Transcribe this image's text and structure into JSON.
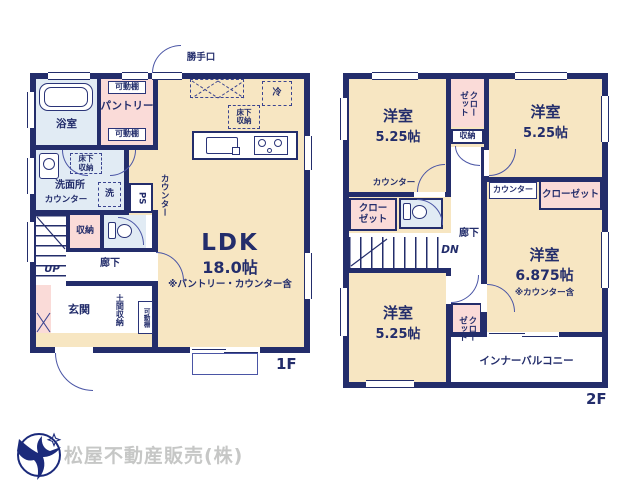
{
  "company": {
    "name": "松屋不動産販売(株)",
    "logo": "bird-in-circle"
  },
  "colors": {
    "wall_navy": "#232d6b",
    "room_beige": "#f7e6c2",
    "room_pink": "#fadbd8",
    "room_blue": "#e1ebf4",
    "line_navy": "#4a55a5",
    "logo_navy": "#1b2a7b",
    "company_gray": "#c6c7c6"
  },
  "f1": {
    "label": "1F",
    "ldk": {
      "name": "LDK",
      "size": "18.0帖",
      "note": "※パントリー・カウンター含"
    },
    "bathroom": "浴室",
    "pantry": "パントリー",
    "shelf_top": "可動棚",
    "shelf_bottom": "可動棚",
    "backdoor": "勝手口",
    "fridge": "冷",
    "underfloor_kitchen": "床下\n収納",
    "underfloor_washroom": "床下\n収納",
    "washroom": "洗面所",
    "washroom_counter": "カウンター",
    "washer": "洗",
    "ps": "PS",
    "counter": "カウンター",
    "storage": "収納",
    "up": "UP",
    "hall": "廊下",
    "entrance": "玄関",
    "doma": "土間収納",
    "shelf_entrance": "可動棚"
  },
  "f2": {
    "label": "2F",
    "room_nw": {
      "name": "洋室",
      "size": "5.25帖"
    },
    "room_ne": {
      "name": "洋室",
      "size": "5.25帖"
    },
    "room_sw": {
      "name": "洋室",
      "size": "5.25帖"
    },
    "room_se": {
      "name": "洋室",
      "size": "6.875帖",
      "note": "※カウンター含"
    },
    "closet_top": "クロー\nゼット",
    "storage_mid": "収納",
    "counter_w": "カウンター",
    "counter_e": "カウンター",
    "closet_e": "クローゼット",
    "closet_w": "クロー\nゼット",
    "closet_s": "クロー\nゼット",
    "hall": "廊下",
    "dn": "DN",
    "balcony": "インナーバルコニー"
  }
}
